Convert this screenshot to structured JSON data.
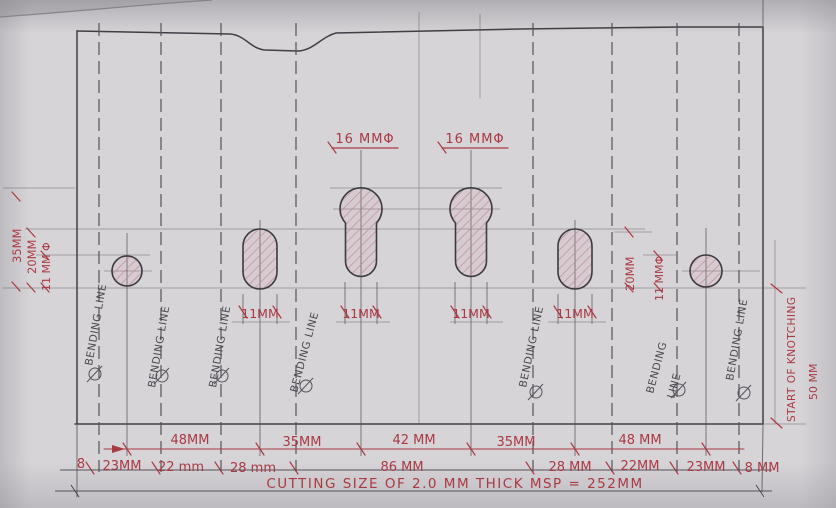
{
  "sheet": {
    "cutting_note": "CUTTING SIZE OF 2.0 MM THICK MSP = 252MM",
    "labels": {
      "bending_line": "BENDING LINE",
      "bending_word": "BENDING",
      "line_word": "LINE",
      "dia_16": "16 MMΦ",
      "w_11": "11MM",
      "start_knotching": "START OF KNOTCHING",
      "d50": "50 MM",
      "left_35": "35MM",
      "left_20": "20MM",
      "left_11dia": "11 MM Φ",
      "right_20": "20MM",
      "right_11dia": "11 MMΦ"
    },
    "dim_row_centers": [
      "48MM",
      "35MM",
      "42 MM",
      "35MM",
      "48 MM"
    ],
    "dim_row_segments": [
      "8",
      "23MM",
      "22 mm",
      "28 mm",
      "86 MM",
      "28 MM",
      "22MM",
      "23MM",
      "8 MM"
    ],
    "colors": {
      "ink": "#a83a42",
      "pencil": "#55525a",
      "paper": "#d7d4d8"
    }
  }
}
